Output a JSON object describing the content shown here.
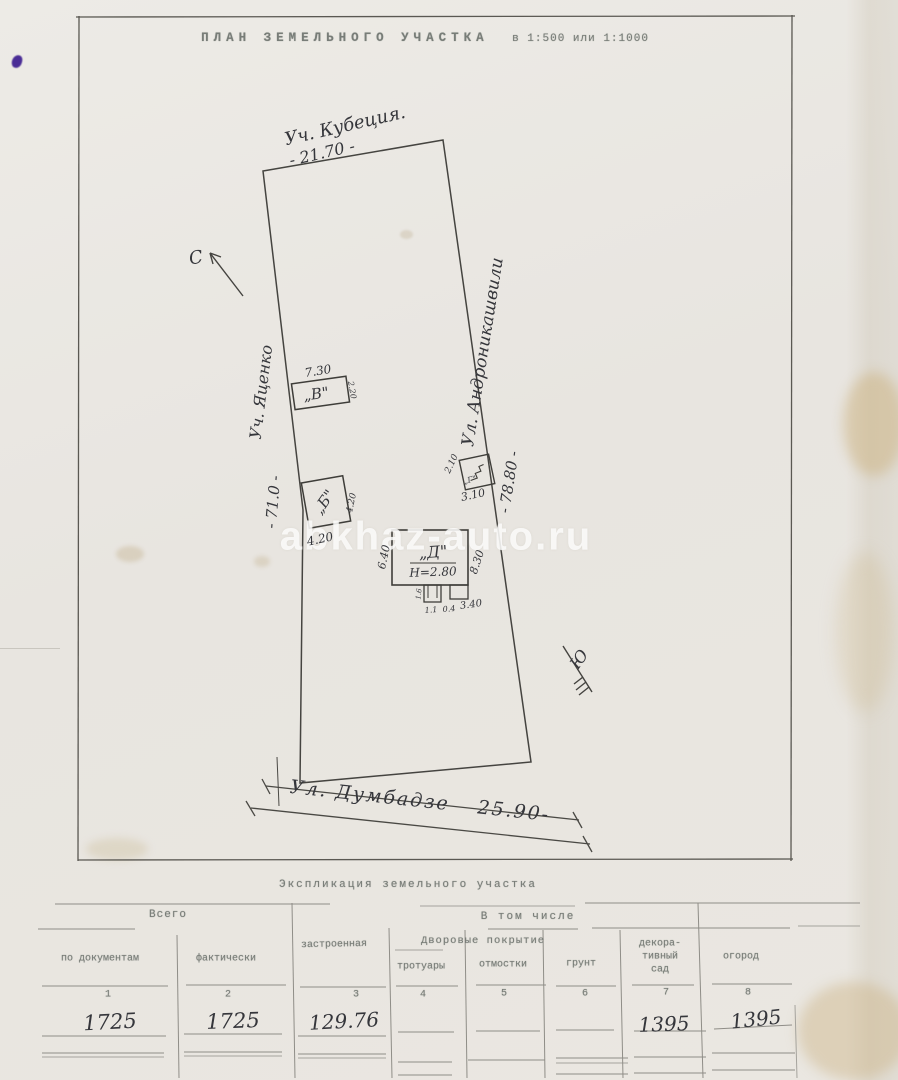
{
  "page": {
    "title_main": "ПЛАН ЗЕМЕЛЬНОГО УЧАСТКА",
    "title_scale": "в 1:500 или 1:1000"
  },
  "plan": {
    "watermark": "abkhaz-auto.ru",
    "compass": {
      "north": "С",
      "south": "Ю"
    },
    "boundaries": {
      "top_neighbor": "Уч. Кубеция.",
      "top_length": "- 21.70 -",
      "left_neighbor": "Уч.  Яценко",
      "left_length": "- 71.0 -",
      "right_street": "Ул. Андроникашвили",
      "right_length": "- 78.80 -",
      "bottom_street": "Ул. Думбадзе",
      "bottom_length": "25.90-"
    },
    "buildings": {
      "v": {
        "label": "„В\"",
        "dim_top": "7.30",
        "dim_right": "2.20"
      },
      "b": {
        "label": "„Б\"",
        "dim_bottom": "4.20",
        "dim_right": "4.20"
      },
      "g": {
        "label": "„Г\"",
        "dim_top": "2.10",
        "dim_bottom": "3.10"
      },
      "d": {
        "label": "„Д\"",
        "height": "Н=2.80",
        "dim_left": "6.40",
        "dim_right": "8.30",
        "dim_bottom_1": "1.1",
        "dim_bottom_2": "0.4",
        "dim_bottom_3": "3.40",
        "dim_notch": "1.6"
      }
    }
  },
  "table": {
    "title": "Экспликация земельного участка",
    "group_total": "Всего",
    "group_including": "В том числе",
    "group_yard": "Дворовые покрытие",
    "col1": "по документам",
    "col2": "фактически",
    "col3": "застроенная",
    "col4": "тротуары",
    "col5": "отмостки",
    "col6": "грунт",
    "col7_l1": "декора-",
    "col7_l2": "тивный",
    "col7_l3": "сад",
    "col8": "огород",
    "numbers": [
      "1",
      "2",
      "3",
      "4",
      "5",
      "6",
      "7",
      "8"
    ],
    "values": {
      "v1": "1725",
      "v2": "1725",
      "v3": "129.76",
      "v7": "1395",
      "v8": "1395"
    }
  }
}
